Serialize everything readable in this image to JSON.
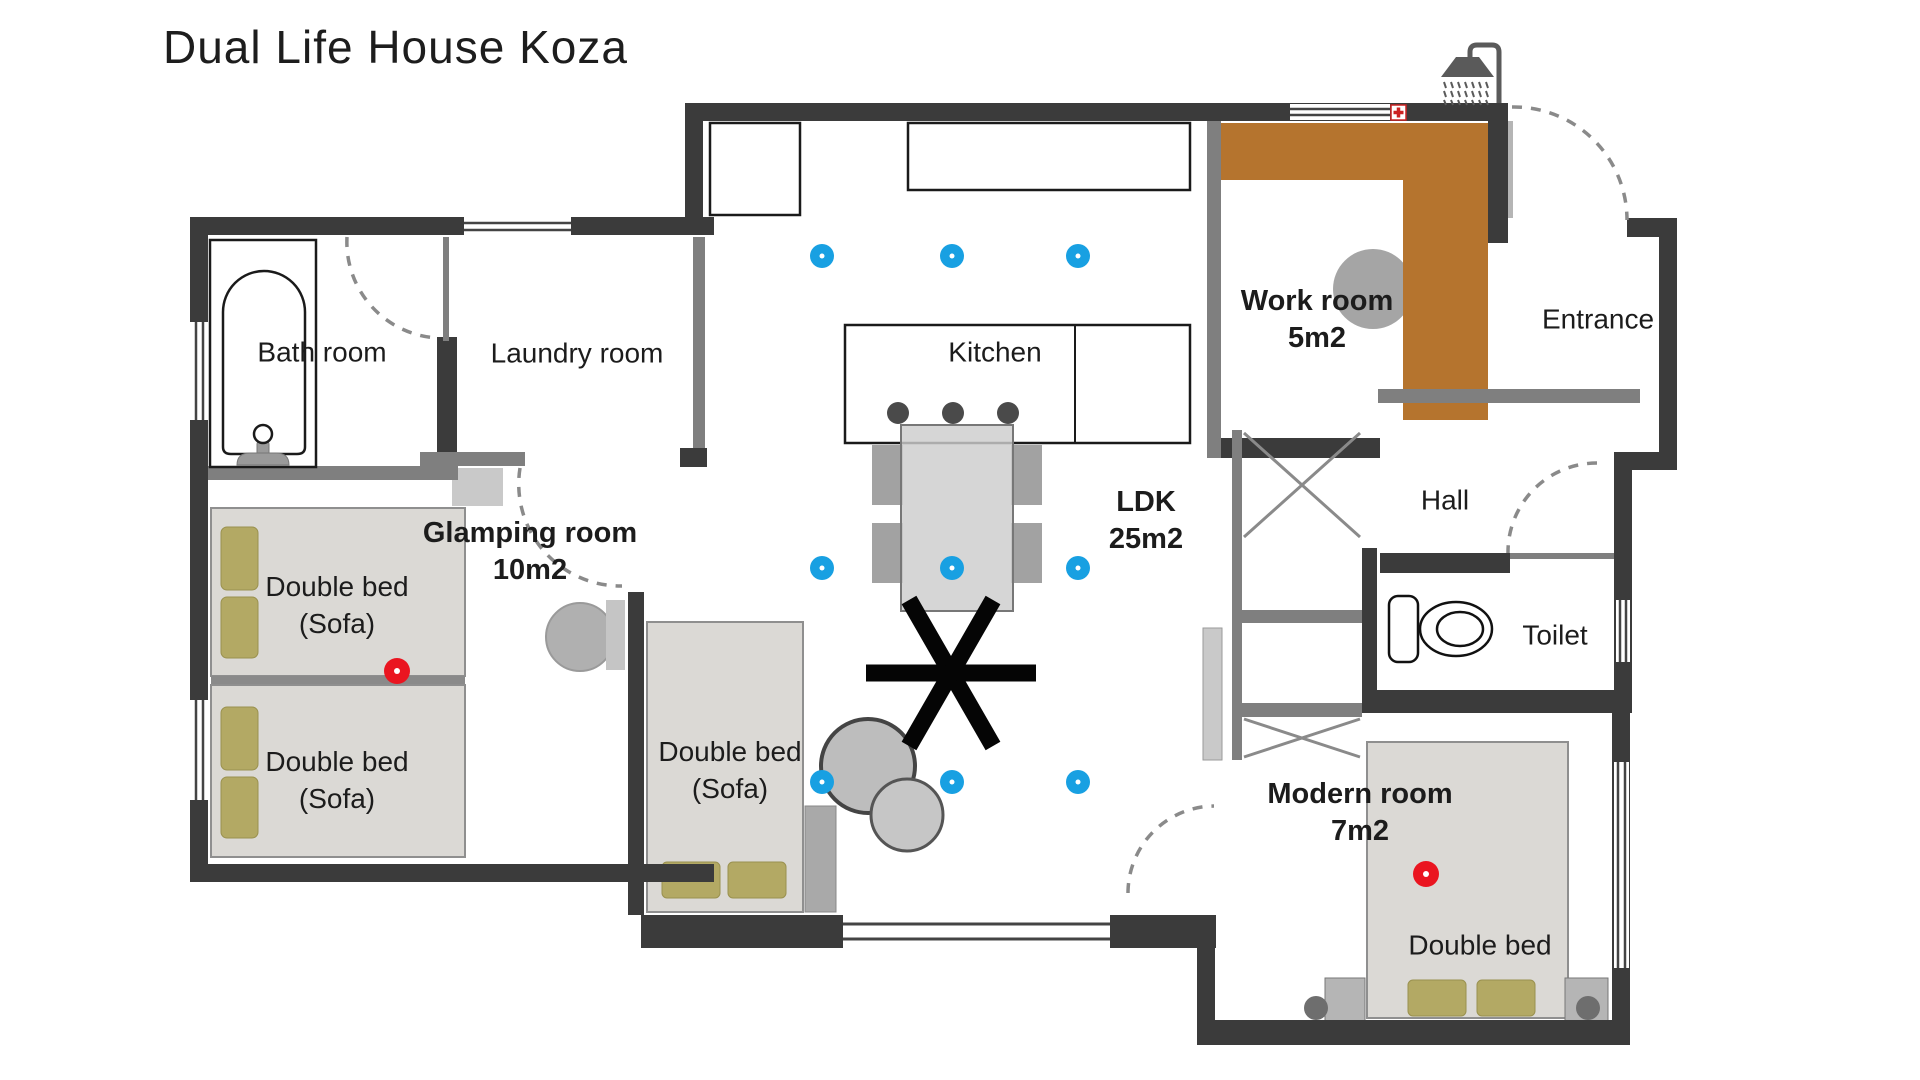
{
  "title": "Dual Life House Koza",
  "rooms": {
    "bath": {
      "label": "Bath room"
    },
    "laundry": {
      "label": "Laundry room"
    },
    "glamping": {
      "label": "Glamping room",
      "area": "10m2"
    },
    "kitchen": {
      "label": "Kitchen"
    },
    "ldk": {
      "label": "LDK",
      "area": "25m2"
    },
    "work": {
      "label": "Work room",
      "area": "5m2"
    },
    "entrance": {
      "label": "Entrance"
    },
    "hall": {
      "label": "Hall"
    },
    "toilet": {
      "label": "Toilet"
    },
    "modern": {
      "label": "Modern room",
      "area": "7m2"
    }
  },
  "furniture": {
    "glamping_bed_1": {
      "label": "Double bed",
      "sublabel": "(Sofa)"
    },
    "glamping_bed_2": {
      "label": "Double bed",
      "sublabel": "(Sofa)"
    },
    "ldk_bed": {
      "label": "Double bed",
      "sublabel": "(Sofa)"
    },
    "modern_bed": {
      "label": "Double bed"
    }
  },
  "colors": {
    "wall": "#3b3b3b",
    "partition": "#7f7f7f",
    "desk_wood": "#b5742e",
    "bed_fill": "#dbd9d5",
    "pillow": "#b3a964",
    "downlight_blue": "#18a0e2",
    "marker_red": "#ea1520"
  },
  "icons": [
    "shower-icon",
    "bathtub-icon",
    "toilet-icon",
    "ceiling-fan-icon",
    "first-aid-cross-icon",
    "downlight-marker",
    "red-light-marker"
  ]
}
